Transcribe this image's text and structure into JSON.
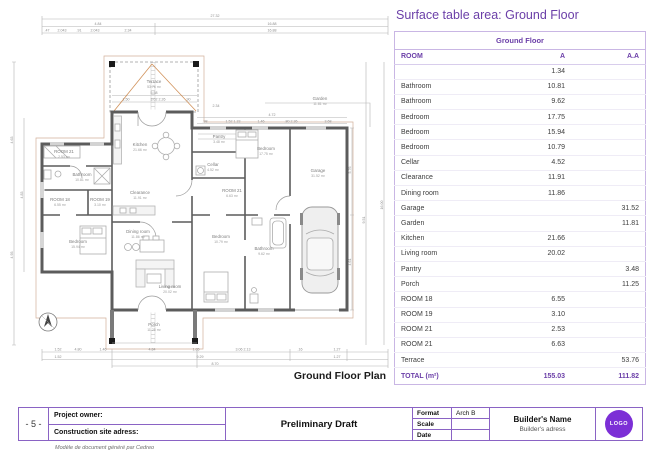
{
  "colors": {
    "accent": "#6b3fa8",
    "table_border": "#c9b6e4",
    "logo": "#7c2fd6",
    "walls": "#5c5c5c",
    "orange_marks": "#c97f3e"
  },
  "main": {
    "title": "Surface table area: Ground Floor"
  },
  "table": {
    "section_title": "Ground Floor",
    "columns": [
      "ROOM",
      "A",
      "A.A"
    ],
    "rows": [
      {
        "room": "",
        "a": "1.34",
        "aa": ""
      },
      {
        "room": "Bathroom",
        "a": "10.81",
        "aa": ""
      },
      {
        "room": "Bathroom",
        "a": "9.62",
        "aa": ""
      },
      {
        "room": "Bedroom",
        "a": "17.75",
        "aa": ""
      },
      {
        "room": "Bedroom",
        "a": "15.94",
        "aa": ""
      },
      {
        "room": "Bedroom",
        "a": "10.79",
        "aa": ""
      },
      {
        "room": "Cellar",
        "a": "4.52",
        "aa": ""
      },
      {
        "room": "Clearance",
        "a": "11.91",
        "aa": ""
      },
      {
        "room": "Dining room",
        "a": "11.86",
        "aa": ""
      },
      {
        "room": "Garage",
        "a": "",
        "aa": "31.52"
      },
      {
        "room": "Garden",
        "a": "",
        "aa": "11.81"
      },
      {
        "room": "Kitchen",
        "a": "21.66",
        "aa": ""
      },
      {
        "room": "Living room",
        "a": "20.02",
        "aa": ""
      },
      {
        "room": "Pantry",
        "a": "",
        "aa": "3.48"
      },
      {
        "room": "Porch",
        "a": "",
        "aa": "11.25"
      },
      {
        "room": "ROOM 18",
        "a": "6.55",
        "aa": ""
      },
      {
        "room": "ROOM 19",
        "a": "3.10",
        "aa": ""
      },
      {
        "room": "ROOM 21",
        "a": "2.53",
        "aa": ""
      },
      {
        "room": "ROOM 21",
        "a": "6.63",
        "aa": ""
      },
      {
        "room": "Terrace",
        "a": "",
        "aa": "53.76"
      }
    ],
    "total": {
      "label": "TOTAL (m²)",
      "a": "155.03",
      "aa": "111.82"
    }
  },
  "plan": {
    "caption": "Ground Floor Plan",
    "rooms": [
      {
        "name": "Terrace",
        "area": "53.76 m²",
        "x": 154,
        "y": 83
      },
      {
        "name": "Garden",
        "area": "11.81 m²",
        "x": 320,
        "y": 100
      },
      {
        "name": "Kitchen",
        "area": "21.66 m²",
        "x": 140,
        "y": 146
      },
      {
        "name": "Pantry",
        "area": "3.48 m²",
        "x": 219,
        "y": 138
      },
      {
        "name": "Cellar",
        "area": "4.52 m²",
        "x": 213,
        "y": 166
      },
      {
        "name": "ROOM 21",
        "area": "6.63 m²",
        "x": 232,
        "y": 192
      },
      {
        "name": "Bedroom",
        "area": "17.75 m²",
        "x": 266,
        "y": 150
      },
      {
        "name": "Garage",
        "area": "31.52 m²",
        "x": 318,
        "y": 172
      },
      {
        "name": "ROOM 21",
        "area": "2.53 m²",
        "x": 64,
        "y": 153
      },
      {
        "name": "Bathroom",
        "area": "10.81 m²",
        "x": 82,
        "y": 176
      },
      {
        "name": "ROOM 18",
        "area": "6.55 m²",
        "x": 60,
        "y": 201
      },
      {
        "name": "ROOM 19",
        "area": "3.10 m²",
        "x": 100,
        "y": 201
      },
      {
        "name": "Clearance",
        "area": "11.91 m²",
        "x": 140,
        "y": 194
      },
      {
        "name": "Bedroom",
        "area": "15.94 m²",
        "x": 78,
        "y": 243
      },
      {
        "name": "Dining room",
        "area": "11.86 m²",
        "x": 138,
        "y": 233
      },
      {
        "name": "Living room",
        "area": "20.02 m²",
        "x": 170,
        "y": 288
      },
      {
        "name": "Bedroom",
        "area": "10.79 m²",
        "x": 221,
        "y": 238
      },
      {
        "name": "Bathroom",
        "area": "9.62 m²",
        "x": 264,
        "y": 250
      },
      {
        "name": "Porch",
        "area": "11.25 m²",
        "x": 154,
        "y": 326
      }
    ],
    "dims": [
      {
        "t": "27.32",
        "x": 215,
        "y": 17
      },
      {
        "t": "4.84",
        "x": 98,
        "y": 25
      },
      {
        "t": "16.88",
        "x": 272,
        "y": 25
      },
      {
        "t": ".47",
        "x": 47,
        "y": 31.5
      },
      {
        "t": "2.043",
        "x": 62,
        "y": 31.5
      },
      {
        "t": ".91",
        "x": 79,
        "y": 31.5
      },
      {
        "t": "2.043",
        "x": 95,
        "y": 31.5
      },
      {
        "t": "2.34",
        "x": 128,
        "y": 31.5
      },
      {
        "t": "16.88",
        "x": 272,
        "y": 31.5
      },
      {
        "t": "5.58",
        "x": 154,
        "y": 94
      },
      {
        "t": "1.50",
        "x": 126,
        "y": 100.5
      },
      {
        "t": "3.02 2.26",
        "x": 158,
        "y": 100.5
      },
      {
        "t": ".90",
        "x": 188,
        "y": 100.5
      },
      {
        "t": "2.34",
        "x": 216,
        "y": 107
      },
      {
        "t": "4.72",
        "x": 272,
        "y": 116
      },
      {
        "t": ".98",
        "x": 205,
        "y": 122.5
      },
      {
        "t": "1.52 1.33",
        "x": 233,
        "y": 122.5
      },
      {
        "t": "1.46",
        "x": 261,
        "y": 122.5
      },
      {
        "t": ".80 2.36",
        "x": 291,
        "y": 122.5
      },
      {
        "t": "3.68",
        "x": 328,
        "y": 122.5
      },
      {
        "t": "4.63",
        "x": 13,
        "y": 140,
        "r": -90
      },
      {
        "t": "4.93",
        "x": 13,
        "y": 255,
        "r": -90
      },
      {
        "t": "4.83",
        "x": 23,
        "y": 195,
        "r": -90
      },
      {
        "t": "5.76",
        "x": 351,
        "y": 170,
        "r": -90
      },
      {
        "t": "4.61",
        "x": 351,
        "y": 262,
        "r": -90
      },
      {
        "t": "9.51",
        "x": 365,
        "y": 220,
        "r": -90
      },
      {
        "t": "16.00",
        "x": 383,
        "y": 205,
        "r": -90
      },
      {
        "t": "1.52",
        "x": 58,
        "y": 350.5
      },
      {
        "t": "4.80",
        "x": 78,
        "y": 350.5
      },
      {
        "t": "1.46",
        "x": 103,
        "y": 350.5
      },
      {
        "t": "4.84",
        "x": 152,
        "y": 350.5
      },
      {
        "t": "1.05",
        "x": 196,
        "y": 350.5
      },
      {
        "t": "3.06 2.13",
        "x": 243,
        "y": 350.5
      },
      {
        "t": ".16",
        "x": 300,
        "y": 350.5
      },
      {
        "t": "1.27",
        "x": 337,
        "y": 350.5
      },
      {
        "t": "1.52",
        "x": 58,
        "y": 358
      },
      {
        "t": "9.29",
        "x": 200,
        "y": 358
      },
      {
        "t": "1.27",
        "x": 337,
        "y": 358
      },
      {
        "t": "8.70",
        "x": 215,
        "y": 365
      }
    ]
  },
  "titleblock": {
    "page": "- 5 -",
    "owner_label": "Project owner:",
    "site_label": "Construction site adress:",
    "draft": "Preliminary Draft",
    "format_label": "Format",
    "format_value": "Arch B",
    "scale_label": "Scale",
    "scale_value": "",
    "date_label": "Date",
    "date_value": "",
    "builder_name": "Builder's Name",
    "builder_address": "Builder's adress",
    "logo": "LOGO"
  },
  "footer": {
    "note": "Modèle de document généré par Cedreo"
  }
}
